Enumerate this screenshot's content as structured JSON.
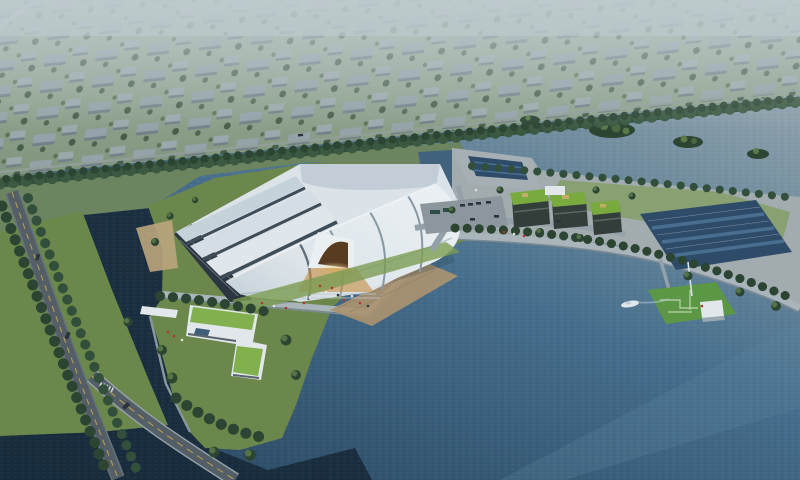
{
  "scene": {
    "type": "aerial-architectural-rendering",
    "subject": "lakeside-exhibition-hall-campus",
    "elements": [
      "distant-city",
      "tree-belt",
      "river",
      "lake",
      "pond",
      "channel",
      "main-exhibition-hall",
      "membrane-roof",
      "stepped-shells",
      "entrance-glow",
      "lawn-island",
      "promenade",
      "wood-deck",
      "office-cluster-green-roofs",
      "solar-array",
      "dock-plaza",
      "parking-area",
      "u-shaped-building",
      "entrance-canopy",
      "left-road",
      "bridge",
      "pier-helipad",
      "boat",
      "tree-islands",
      "people",
      "vehicles"
    ],
    "colors": {
      "hazeTop": "#c6d2d4",
      "cityGroundLight": "#a8b7a6",
      "cityGround": "#84997f",
      "bankGreen": "#6f8760",
      "blockTop": "#9aa7b0",
      "blockSide": "#73808b",
      "treeDark": "#2c4531",
      "treeLight": "#5d7c49",
      "beltGreen": "#31503a",
      "riverLight": "#8ea2ad",
      "lakeMid": "#47708e",
      "lakeDeep": "#27455f",
      "channelDark": "#152837",
      "notchBlue": "#41637e",
      "lawn": "#6e8a4a",
      "lawnBright": "#7fa052",
      "roofWhite": "#f2f6f8",
      "roofShadeLight": "#e2e9ee",
      "roofShade": "#cdd8df",
      "ribDark": "#3f4e58",
      "ribSoft": "#8c9ba7",
      "facadeDark": "#2b363f",
      "promenade": "#aeb9bf",
      "promenadeShade": "#7e8d96",
      "junctionGrey": "#a7b0b2",
      "deckTan": "#b09672",
      "sandTan": "#c2aa80",
      "roadGrey": "#555f66",
      "roadEdge": "#6a757c",
      "roadYellow": "#c8a44e",
      "glowGold": "#f6dc9a",
      "entranceGold": "#c98f3e",
      "archBrown": "#5a3c20",
      "greenRoof": "#7cae3c",
      "clusterFacade": "#333d39",
      "solarDark": "#2e4d6a",
      "solarLight": "#4a7092",
      "pierGreen": "#5e9b44",
      "structWhite": "#e9eef1",
      "peopleRed": "#b5382e",
      "carDark": "#2a3238",
      "busTeal": "#2e4f46"
    }
  }
}
